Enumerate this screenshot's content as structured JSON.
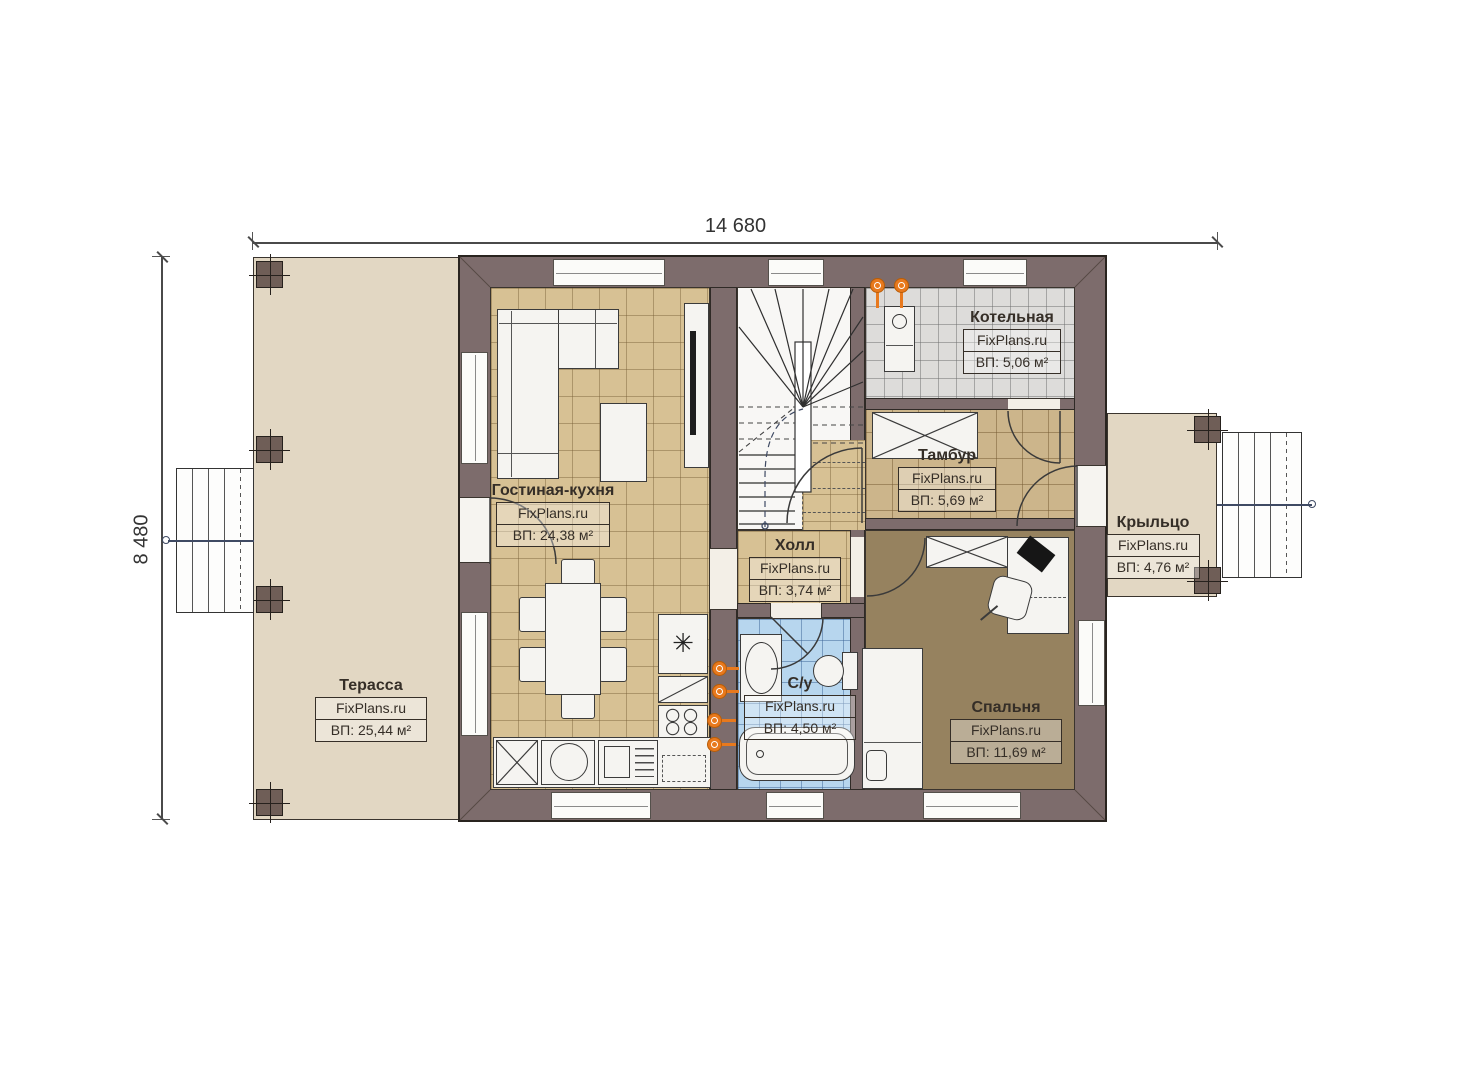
{
  "plan_title": "План 1-го этажа",
  "dimensions": {
    "width_label": "14 680",
    "height_label": "8 480"
  },
  "watermark": "FixPlans.ru",
  "rooms": {
    "terrace": {
      "name": "Терасса",
      "area": "ВП: 25,44 м²"
    },
    "living": {
      "name": "Гостиная-кухня",
      "area": "ВП: 24,38 м²"
    },
    "hall": {
      "name": "Холл",
      "area": "ВП: 3,74 м²"
    },
    "bathroom": {
      "name": "С/у",
      "area": "ВП: 4,50 м²"
    },
    "bedroom": {
      "name": "Спальня",
      "area": "ВП: 11,69 м²"
    },
    "tambour": {
      "name": "Тамбур",
      "area": "ВП: 5,69 м²"
    },
    "boiler": {
      "name": "Котельная",
      "area": "ВП: 5,06 м²"
    },
    "porch": {
      "name": "Крыльцо",
      "area": "ВП: 4,76 м²"
    }
  },
  "icons": {
    "fridge_symbol": "✳"
  },
  "colors": {
    "wall": "#7d6c6c",
    "terrace_floor": "#e2d7c3",
    "living_tiles": "#d7c194",
    "bath_tiles": "#b7d6ee",
    "boiler_tiles": "#dddcda",
    "bedroom_floor": "#96825f",
    "utility_accent": "#e8791d"
  }
}
